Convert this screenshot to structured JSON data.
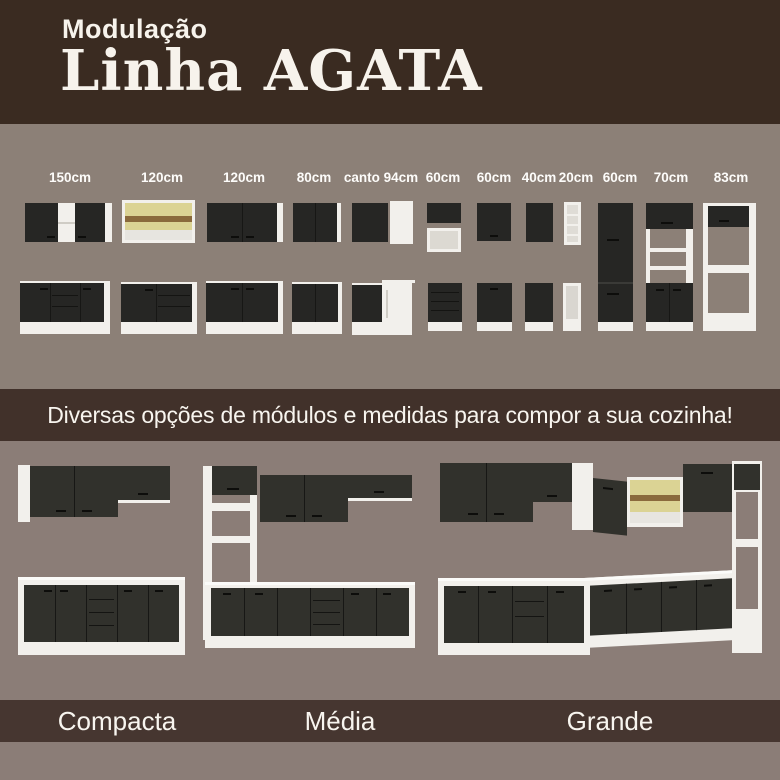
{
  "header": {
    "subtitle": "Modulação",
    "title": "Linha AGATA"
  },
  "modules": {
    "sizes": [
      "150cm",
      "120cm",
      "120cm",
      "80cm",
      "canto 94cm",
      "60cm",
      "60cm",
      "40cm",
      "20cm",
      "60cm",
      "70cm",
      "83cm"
    ]
  },
  "banner": {
    "text": "Diversas opções de módulos e medidas para compor a sua cozinha!"
  },
  "kitchens": [
    {
      "label": "Compacta"
    },
    {
      "label": "Média"
    },
    {
      "label": "Grande"
    }
  ],
  "colors": {
    "header_bg": "#3A2B21",
    "modules_section_bg": "#8C8077",
    "banner_bg": "#41312A",
    "kitchens_section_bg": "#8B7D77",
    "labels_band_bg": "#463630",
    "cabinet_dark": "#262624",
    "carcass_white": "#F2F0EC",
    "glass_yellow": "#DBD394",
    "wood_stripe": "#8A6A3C",
    "text": "#FFFFFF"
  }
}
